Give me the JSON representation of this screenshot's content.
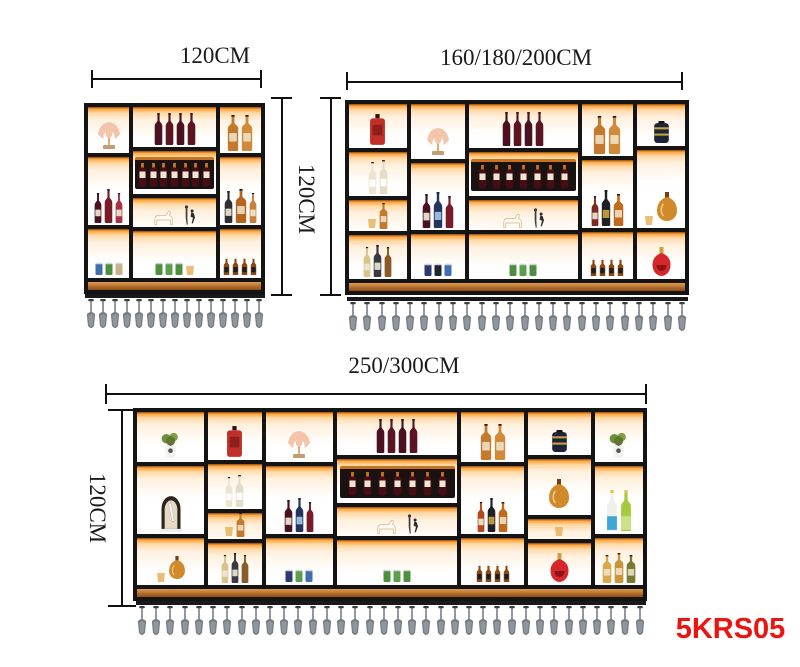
{
  "labels": {
    "unit1_width": "120CM",
    "units_height": "120CM",
    "unit2_width": "160/180/200CM",
    "unit3_width": "250/300CM",
    "unit3_height": "120CM",
    "product_code": "5KRS05"
  },
  "colors": {
    "frame": "#141414",
    "wood": "#b06024",
    "led_glow": "#ffa43a",
    "product_code_red": "#ea1410",
    "dimension_ink": "#101010",
    "glass_gray": "#777d84"
  },
  "units": [
    {
      "name": "wine-shelf-120cm",
      "hanging_glasses": 15,
      "columns": [
        {
          "w": 25,
          "cells": [
            {
              "h": 28,
              "items": [
                {
                  "t": "coral"
                }
              ]
            },
            {
              "h": 42,
              "items": [
                {
                  "t": "wine",
                  "c": "#4a1220",
                  "h": 30,
                  "l": "#efe7d2"
                },
                {
                  "t": "wine",
                  "c": "#7a1b2a",
                  "h": 34
                },
                {
                  "t": "wine",
                  "c": "#a83244",
                  "h": 30,
                  "l": "#efe7d2"
                }
              ]
            },
            {
              "h": 30,
              "items": [
                {
                  "t": "cans",
                  "cs": [
                    "#3f6fae",
                    "#4d8f3f",
                    "#c9b38a"
                  ]
                }
              ]
            }
          ]
        },
        {
          "w": 50,
          "cells": [
            {
              "h": 25,
              "items": [
                {
                  "t": "wine",
                  "c": "#4a1220",
                  "h": 32
                },
                {
                  "t": "wine",
                  "c": "#5c1322",
                  "h": 32
                },
                {
                  "t": "wine",
                  "c": "#4a1220",
                  "h": 32
                },
                {
                  "t": "wine",
                  "c": "#5c1322",
                  "h": 32
                }
              ]
            },
            {
              "h": 27,
              "items": [
                {
                  "t": "rack",
                  "n": 7
                }
              ]
            },
            {
              "h": 18,
              "items": [
                {
                  "t": "figures"
                }
              ]
            },
            {
              "h": 30,
              "items": [
                {
                  "t": "cans",
                  "cs": [
                    "#4d8f3f",
                    "#5aa04a",
                    "#4d8f3f"
                  ]
                },
                {
                  "t": "cup"
                }
              ]
            }
          ]
        },
        {
          "w": 25,
          "cells": [
            {
              "h": 28,
              "items": [
                {
                  "t": "brandy",
                  "c": "#c47a2c",
                  "h": 36
                },
                {
                  "t": "brandy",
                  "c": "#d08a3a",
                  "h": 36
                }
              ]
            },
            {
              "h": 42,
              "items": [
                {
                  "t": "wine",
                  "c": "#2f2f33",
                  "h": 32,
                  "l": "#efe7d2"
                },
                {
                  "t": "brandy",
                  "c": "#b5651d",
                  "h": 34
                },
                {
                  "t": "wine",
                  "c": "#c9803a",
                  "h": 30,
                  "l": "#efe7d2"
                }
              ]
            },
            {
              "h": 30,
              "items": [
                {
                  "t": "beers",
                  "n": 4
                }
              ]
            }
          ]
        }
      ]
    },
    {
      "name": "wine-shelf-160-180-200cm",
      "hanging_glasses": 24,
      "columns": [
        {
          "w": 18,
          "cells": [
            {
              "h": 27,
              "items": [
                {
                  "t": "redsquare"
                }
              ]
            },
            {
              "h": 27,
              "items": [
                {
                  "t": "wine",
                  "c": "#ece5d2",
                  "h": 32,
                  "l": "#ffffff"
                },
                {
                  "t": "wine",
                  "c": "#e4dcc6",
                  "h": 34,
                  "l": "#ffffff"
                }
              ]
            },
            {
              "h": 19,
              "items": [
                {
                  "t": "cup"
                },
                {
                  "t": "brandy",
                  "c": "#c47a2c",
                  "h": 26
                }
              ]
            },
            {
              "h": 27,
              "items": [
                {
                  "t": "wine",
                  "c": "#d8c38a",
                  "h": 30,
                  "l": "#efe7d2"
                },
                {
                  "t": "wine",
                  "c": "#3a3a40",
                  "h": 32,
                  "l": "#efe7d2"
                },
                {
                  "t": "wine",
                  "c": "#8a5a28",
                  "h": 30
                }
              ]
            }
          ]
        },
        {
          "w": 17,
          "cells": [
            {
              "h": 33,
              "items": [
                {
                  "t": "coral"
                }
              ]
            },
            {
              "h": 40,
              "items": [
                {
                  "t": "wine",
                  "c": "#4a1220",
                  "h": 34,
                  "l": "#efe7d2"
                },
                {
                  "t": "wine",
                  "c": "#23355c",
                  "h": 36,
                  "l": "#9fc3e8"
                },
                {
                  "t": "wine",
                  "c": "#7a1b2a",
                  "h": 32
                }
              ]
            },
            {
              "h": 27,
              "items": [
                {
                  "t": "cans",
                  "cs": [
                    "#2c3a6e",
                    "#1f2430",
                    "#3f6fae"
                  ]
                }
              ]
            }
          ]
        },
        {
          "w": 34,
          "cells": [
            {
              "h": 27,
              "items": [
                {
                  "t": "wine",
                  "c": "#4a1220",
                  "h": 34
                },
                {
                  "t": "wine",
                  "c": "#5c1322",
                  "h": 34
                },
                {
                  "t": "wine",
                  "c": "#4a1220",
                  "h": 34
                },
                {
                  "t": "wine",
                  "c": "#5c1322",
                  "h": 34
                }
              ]
            },
            {
              "h": 27,
              "items": [
                {
                  "t": "rack",
                  "n": 7
                }
              ]
            },
            {
              "h": 18,
              "items": [
                {
                  "t": "figures"
                }
              ]
            },
            {
              "h": 28,
              "items": [
                {
                  "t": "cans",
                  "cs": [
                    "#4d8f3f",
                    "#5aa04a",
                    "#4d8f3f"
                  ]
                }
              ]
            }
          ]
        },
        {
          "w": 16,
          "cells": [
            {
              "h": 31,
              "items": [
                {
                  "t": "brandy",
                  "c": "#c47a2c",
                  "h": 38
                },
                {
                  "t": "brandy",
                  "c": "#d08a3a",
                  "h": 38
                }
              ]
            },
            {
              "h": 41,
              "items": [
                {
                  "t": "wine",
                  "c": "#7a2a1e",
                  "h": 30,
                  "l": "#efe7d2"
                },
                {
                  "t": "wine",
                  "c": "#1f1f24",
                  "h": 36,
                  "l": "#c9a13f"
                },
                {
                  "t": "brandy",
                  "c": "#c06a1e",
                  "h": 32
                }
              ]
            },
            {
              "h": 28,
              "items": [
                {
                  "t": "beers",
                  "n": 4
                }
              ]
            }
          ]
        },
        {
          "w": 15,
          "cells": [
            {
              "h": 25,
              "items": [
                {
                  "t": "canister"
                }
              ]
            },
            {
              "h": 47,
              "items": [
                {
                  "t": "cup"
                },
                {
                  "t": "bigcognac",
                  "s": 1
                }
              ]
            },
            {
              "h": 28,
              "items": [
                {
                  "t": "reddecanter"
                }
              ]
            }
          ]
        }
      ]
    },
    {
      "name": "wine-shelf-250-300cm",
      "hanging_glasses": 36,
      "columns": [
        {
          "w": 14,
          "cells": [
            {
              "h": 30,
              "items": [
                {
                  "t": "plant"
                }
              ]
            },
            {
              "h": 42,
              "items": [
                {
                  "t": "dome"
                }
              ]
            },
            {
              "h": 28,
              "items": [
                {
                  "t": "cup"
                },
                {
                  "t": "bigcognac",
                  "s": 0.8
                }
              ]
            }
          ]
        },
        {
          "w": 11,
          "cells": [
            {
              "h": 30,
              "items": [
                {
                  "t": "redsquare"
                }
              ]
            },
            {
              "h": 28,
              "items": [
                {
                  "t": "wine",
                  "c": "#ece5d2",
                  "h": 30,
                  "l": "#ffffff"
                },
                {
                  "t": "wine",
                  "c": "#e4dcc6",
                  "h": 32,
                  "l": "#ffffff"
                }
              ]
            },
            {
              "h": 16,
              "items": [
                {
                  "t": "cup"
                },
                {
                  "t": "brandy",
                  "c": "#c47a2c",
                  "h": 24
                }
              ]
            },
            {
              "h": 26,
              "items": [
                {
                  "t": "wine",
                  "c": "#d8c38a",
                  "h": 28,
                  "l": "#efe7d2"
                },
                {
                  "t": "wine",
                  "c": "#3a3a40",
                  "h": 30,
                  "l": "#efe7d2"
                },
                {
                  "t": "wine",
                  "c": "#8a5a28",
                  "h": 28
                }
              ]
            }
          ]
        },
        {
          "w": 14,
          "cells": [
            {
              "h": 30,
              "items": [
                {
                  "t": "coral"
                }
              ]
            },
            {
              "h": 42,
              "items": [
                {
                  "t": "wine",
                  "c": "#4a1220",
                  "h": 32,
                  "l": "#efe7d2"
                },
                {
                  "t": "wine",
                  "c": "#23355c",
                  "h": 34,
                  "l": "#9fc3e8"
                },
                {
                  "t": "wine",
                  "c": "#7a1b2a",
                  "h": 30
                }
              ]
            },
            {
              "h": 28,
              "items": [
                {
                  "t": "cans",
                  "cs": [
                    "#2c3a6e",
                    "#5aa04a",
                    "#3f6fae"
                  ]
                }
              ]
            }
          ]
        },
        {
          "w": 25,
          "cells": [
            {
              "h": 27,
              "items": [
                {
                  "t": "wine",
                  "c": "#4a1220",
                  "h": 34
                },
                {
                  "t": "wine",
                  "c": "#5c1322",
                  "h": 34
                },
                {
                  "t": "wine",
                  "c": "#4a1220",
                  "h": 34
                },
                {
                  "t": "wine",
                  "c": "#5c1322",
                  "h": 34
                }
              ]
            },
            {
              "h": 27,
              "items": [
                {
                  "t": "rack",
                  "n": 7
                }
              ]
            },
            {
              "h": 18,
              "items": [
                {
                  "t": "figures"
                }
              ]
            },
            {
              "h": 28,
              "items": [
                {
                  "t": "cans",
                  "cs": [
                    "#4d8f3f",
                    "#5aa04a",
                    "#4d8f3f"
                  ]
                }
              ]
            }
          ]
        },
        {
          "w": 13,
          "cells": [
            {
              "h": 30,
              "items": [
                {
                  "t": "brandy",
                  "c": "#c47a2c",
                  "h": 36
                },
                {
                  "t": "brandy",
                  "c": "#d08a3a",
                  "h": 36
                }
              ]
            },
            {
              "h": 42,
              "items": [
                {
                  "t": "wine",
                  "c": "#b5481e",
                  "h": 30,
                  "l": "#efe7d2"
                },
                {
                  "t": "wine",
                  "c": "#1f1f24",
                  "h": 34,
                  "l": "#c9a13f"
                },
                {
                  "t": "brandy",
                  "c": "#c06a1e",
                  "h": 30
                }
              ]
            },
            {
              "h": 28,
              "items": [
                {
                  "t": "beers",
                  "n": 4
                }
              ]
            }
          ]
        },
        {
          "w": 13,
          "cells": [
            {
              "h": 27,
              "items": [
                {
                  "t": "canister"
                }
              ]
            },
            {
              "h": 35,
              "items": [
                {
                  "t": "bigcognac",
                  "s": 1
                }
              ]
            },
            {
              "h": 12,
              "items": [
                {
                  "t": "cup"
                }
              ]
            },
            {
              "h": 26,
              "items": [
                {
                  "t": "reddecanter"
                }
              ]
            }
          ]
        },
        {
          "w": 10,
          "cells": [
            {
              "h": 30,
              "items": [
                {
                  "t": "plant"
                }
              ]
            },
            {
              "h": 42,
              "items": [
                {
                  "t": "tall",
                  "c": "#eef0ec",
                  "l": "#3fa6d8"
                },
                {
                  "t": "tall",
                  "c": "#a5c93f",
                  "l": "#cfe08a"
                }
              ]
            },
            {
              "h": 28,
              "items": [
                {
                  "t": "brandy",
                  "c": "#d8a84e",
                  "h": 28
                },
                {
                  "t": "brandy",
                  "c": "#c9943a",
                  "h": 30
                },
                {
                  "t": "brandy",
                  "c": "#7a7a30",
                  "h": 28
                }
              ]
            }
          ]
        }
      ]
    }
  ]
}
